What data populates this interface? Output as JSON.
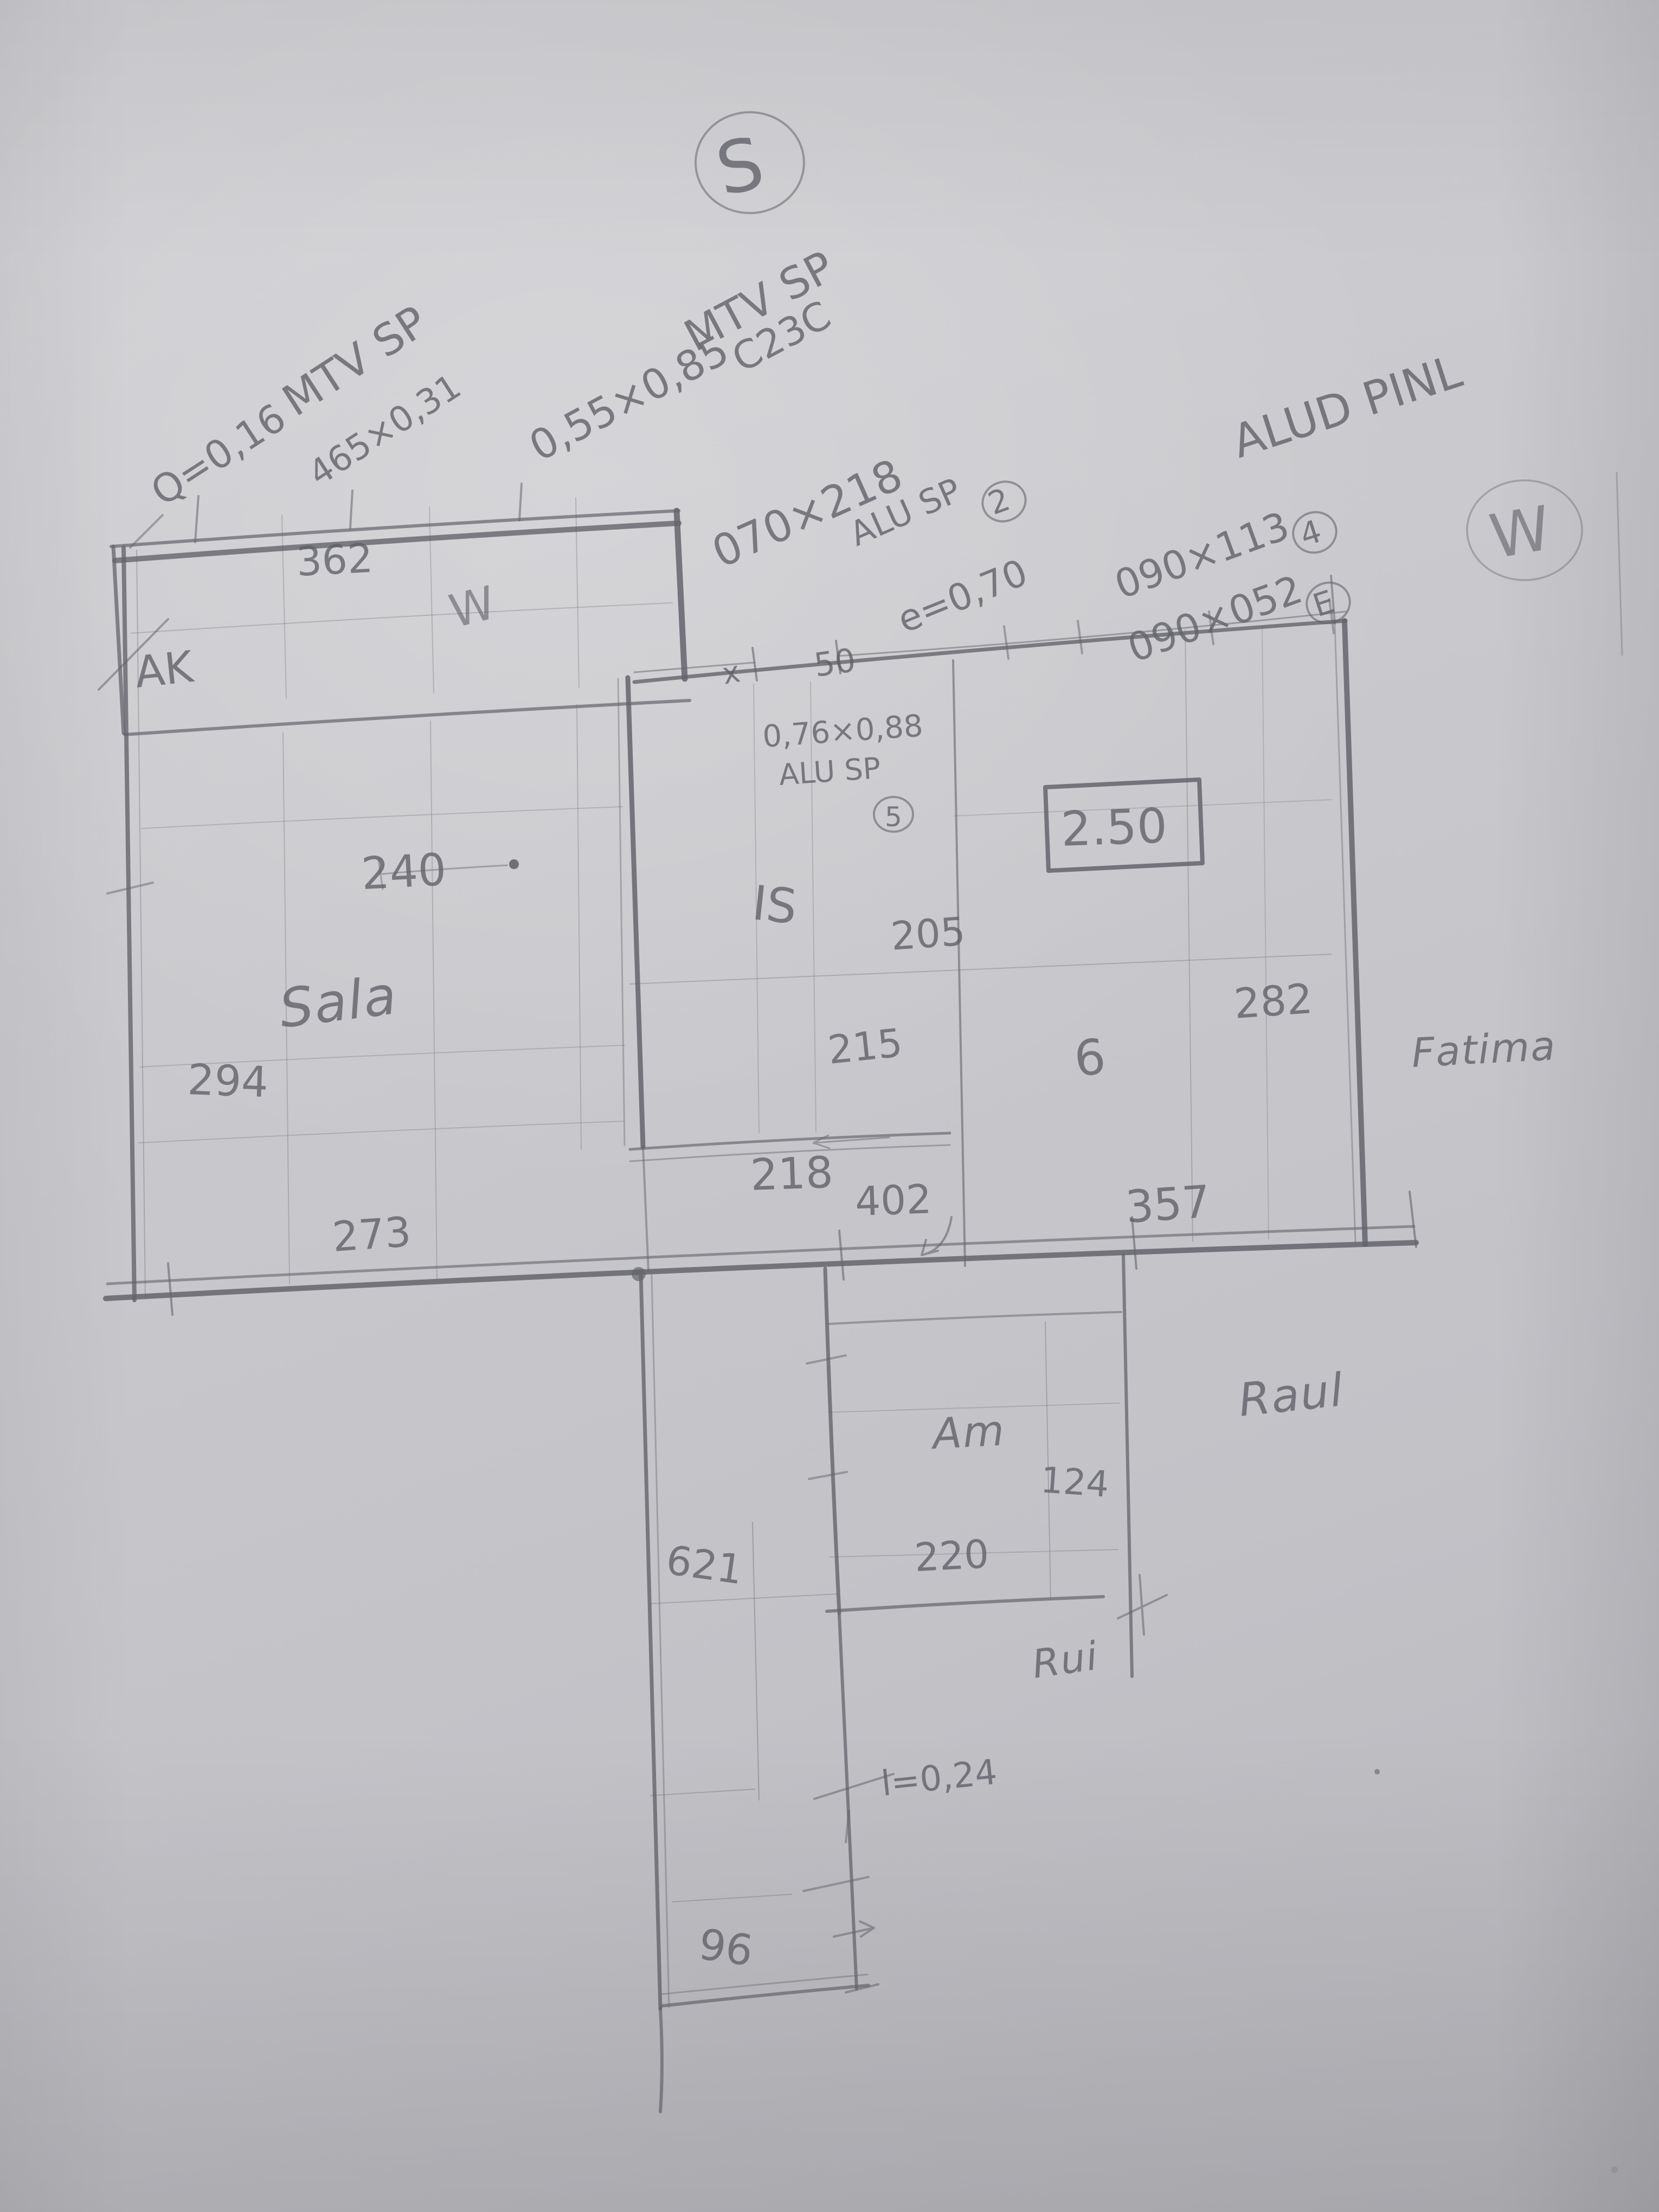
{
  "colors": {
    "paper": "#c9c9cd",
    "pencil": "#64646c"
  },
  "compass": {
    "south_label": "S",
    "west_label": "W"
  },
  "specs": {
    "s1_product": "MTV SP",
    "s1_area": "Q=0,16",
    "s1_size": "465×0,31",
    "s2_product": "MTV SP",
    "s2_size": "0,55×0,85",
    "s2_code": "C23C",
    "s3_size": "070×218",
    "s3_product": "ALU SP",
    "s3_ref": "2",
    "s4_thickness": "e=0,70",
    "s5_size": "090×113",
    "s5_ref": "4",
    "s6_size": "090×052",
    "s6_ref": "E",
    "s7_material": "ALUD PINL",
    "s8_size": "0,76×0,88",
    "s8_product": "ALU SP",
    "s8_ref": "5"
  },
  "rooms": {
    "living": "Sala",
    "bath": "IS",
    "closet": "Am",
    "ak": "AK",
    "terrace_mark": "W"
  },
  "names": {
    "fatima": "Fatima",
    "raul": "Raul",
    "rui": "Rui"
  },
  "dims": {
    "d362": "362",
    "d240": "240",
    "d294": "294",
    "d273": "273",
    "d205": "205",
    "d215": "215",
    "d218": "218",
    "d402": "402",
    "d357": "357",
    "d282": "282",
    "d124": "124",
    "d220": "220",
    "d621": "621",
    "d96": "96",
    "height_boxed": "2.50",
    "ref6": "6",
    "door_mark": "x",
    "door_width": "50",
    "wall_note": "l=0,24"
  }
}
